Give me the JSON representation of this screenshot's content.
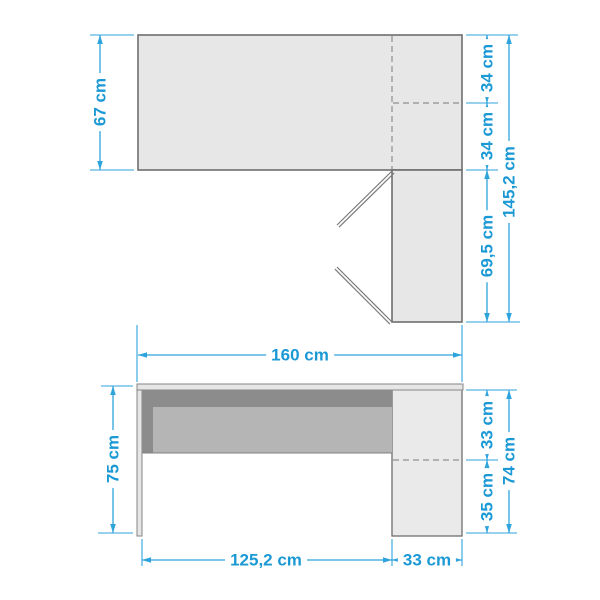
{
  "diagram": {
    "unit": "cm",
    "colors": {
      "dimension_blue": "#1B99D5",
      "outline_gray": "#6E6E6E",
      "fill_light": "#E7E7E7",
      "fill_dark": "#8C8C8C",
      "fill_medium": "#B5B5B5",
      "background": "#FFFFFF"
    },
    "dimensions": {
      "top_view": {
        "depth_left": "67 cm",
        "right_upper": "34 cm",
        "right_lower": "34 cm",
        "return_depth": "69,5 cm",
        "overall_depth": "145,2 cm"
      },
      "front_view": {
        "overall_width": "160 cm",
        "height_left": "75 cm",
        "cabinet_upper": "33 cm",
        "cabinet_lower": "35 cm",
        "cabinet_height": "74 cm",
        "bottom_desk": "125,2 cm",
        "bottom_cabinet": "33 cm"
      }
    }
  }
}
